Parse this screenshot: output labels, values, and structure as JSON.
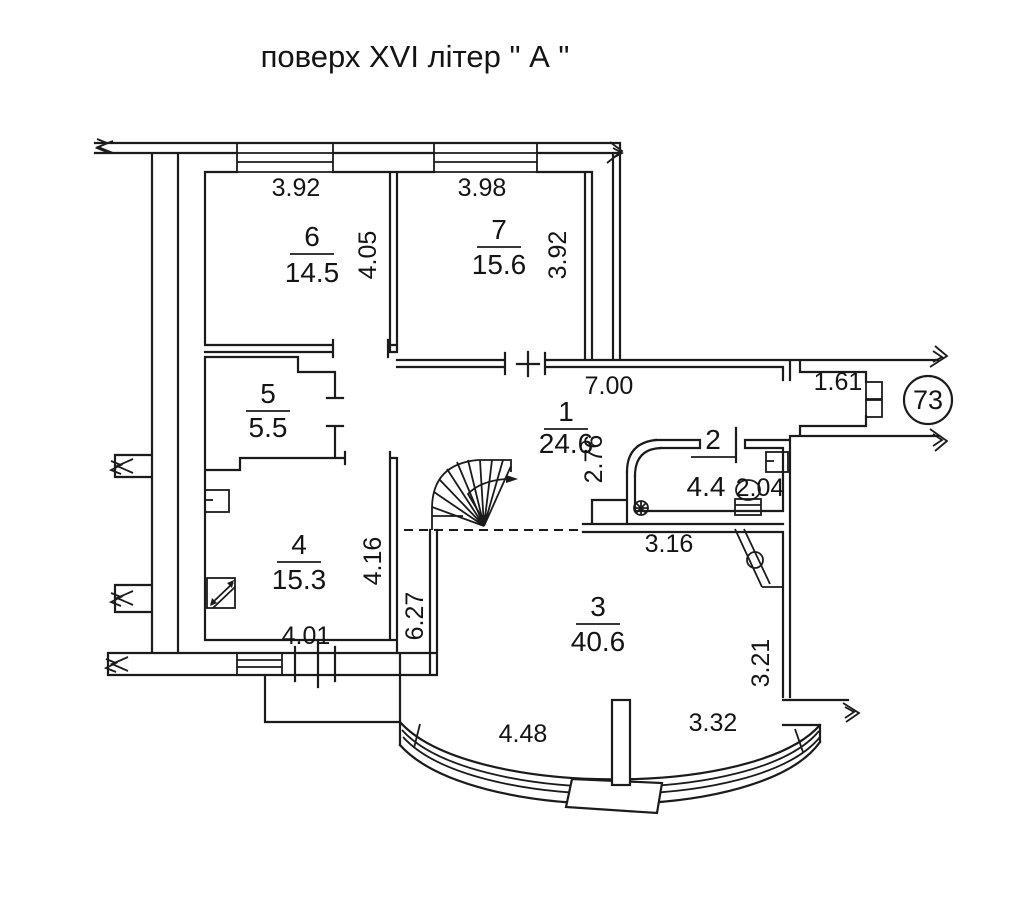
{
  "title": "поверх  XVI літер \" А \"",
  "apartment": {
    "number": "73"
  },
  "rooms": {
    "r1": {
      "number": "1",
      "area": "24.6"
    },
    "r2": {
      "number": "2",
      "area": "4.4"
    },
    "r3": {
      "number": "3",
      "area": "40.6"
    },
    "r4": {
      "number": "4",
      "area": "15.3"
    },
    "r5": {
      "number": "5",
      "area": "5.5"
    },
    "r6": {
      "number": "6",
      "area": "14.5"
    },
    "r7": {
      "number": "7",
      "area": "15.6"
    }
  },
  "dims": {
    "room6_top": "3.92",
    "room7_top": "3.98",
    "room6_side": "4.05",
    "room7_side": "3.92",
    "corridor": "7.00",
    "entry": "1.61",
    "corridor_depth": "2.76",
    "room2_width": "2.04",
    "room2_front": "3.16",
    "room4_side": "4.16",
    "hall_side": "6.27",
    "room4_bottom": "4.01",
    "bay_left": "4.48",
    "bay_right": "3.32",
    "right_side": "3.21"
  },
  "colors": {
    "ink": "#1b1b1b",
    "paper": "#ffffff"
  }
}
